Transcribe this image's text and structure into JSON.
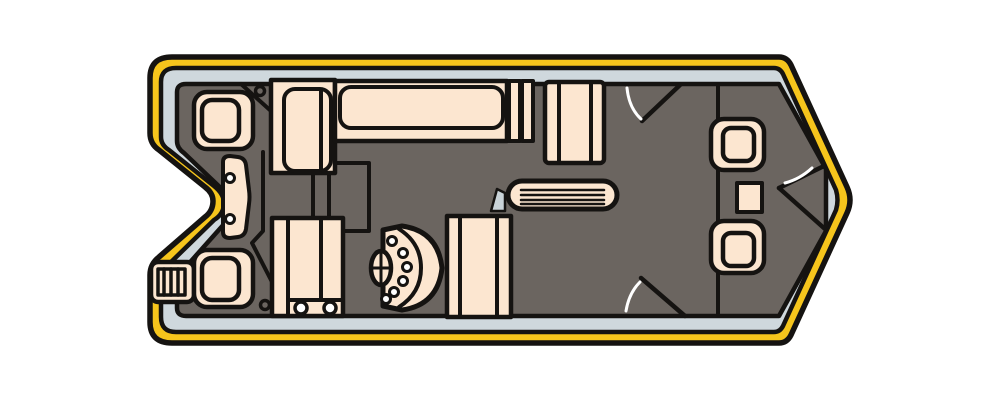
{
  "illustration": {
    "kind": "pontoon-boat-floor-plan-top-view",
    "orientation": "bow-right-stern-left",
    "parts": [
      {
        "name": "hull",
        "desc": "outer pontoon hull band with notched stern and pointed bow"
      },
      {
        "name": "gunwale-rim",
        "desc": "light grey-blue trim ring inside hull"
      },
      {
        "name": "deck-floor",
        "desc": "dark grey deck surface"
      },
      {
        "name": "boarding-ladder",
        "desc": "stern ladder with rungs, lower left"
      },
      {
        "name": "transom-panel",
        "desc": "curved motor-mount panel with two bolts at stern notch"
      },
      {
        "name": "stern-seat-port",
        "desc": "pedestal seat, upper left"
      },
      {
        "name": "stern-seat-starboard",
        "desc": "pedestal seat, lower left"
      },
      {
        "name": "corner-bench-arm",
        "desc": "L-shaped bench arm section, port forward corner"
      },
      {
        "name": "port-side-bench",
        "desc": "long bench along top side"
      },
      {
        "name": "bench-armrest",
        "desc": "slatted armrest at bench end"
      },
      {
        "name": "chaise-lounge",
        "desc": "striped lounge seat, top middle"
      },
      {
        "name": "cocktail-table",
        "desc": "slatted oval table, midship"
      },
      {
        "name": "windscreen-wedge",
        "desc": "small grey windscreen beside helm chair"
      },
      {
        "name": "storage-hatch",
        "desc": "rectangular floor hatch outline"
      },
      {
        "name": "helm-console",
        "desc": "D-shaped console with gauges"
      },
      {
        "name": "steering-wheel",
        "desc": "oval wheel with cross spokes"
      },
      {
        "name": "captain-chair",
        "desc": "striped helm chair"
      },
      {
        "name": "aft-bench-cupholders",
        "desc": "bench with two cupholders, bottom middle-left"
      },
      {
        "name": "side-gate-port",
        "desc": "open gate with swing arc, top side"
      },
      {
        "name": "side-gate-starboard",
        "desc": "open gate with swing arc, bottom side"
      },
      {
        "name": "bow-bulkhead",
        "desc": "vertical divider line before bow section"
      },
      {
        "name": "bow-gate",
        "desc": "nose gate lines with swing arc at bow point"
      },
      {
        "name": "bow-seat-port",
        "desc": "fishing seat, bow upper"
      },
      {
        "name": "bow-seat-starboard",
        "desc": "fishing seat, bow lower"
      },
      {
        "name": "bow-table",
        "desc": "small rectangle between bow seats"
      }
    ]
  },
  "colors": {
    "page_background": "#ffffff",
    "hull": "#F6C51C",
    "outline": "#151311",
    "rim": "#CFD8DD",
    "deck": "#6B6560",
    "upholstery": "#FCE6D0",
    "white": "#FFFFFF",
    "windscreen": "#C9D3D8",
    "swing_arc": "#FFFFFF"
  }
}
